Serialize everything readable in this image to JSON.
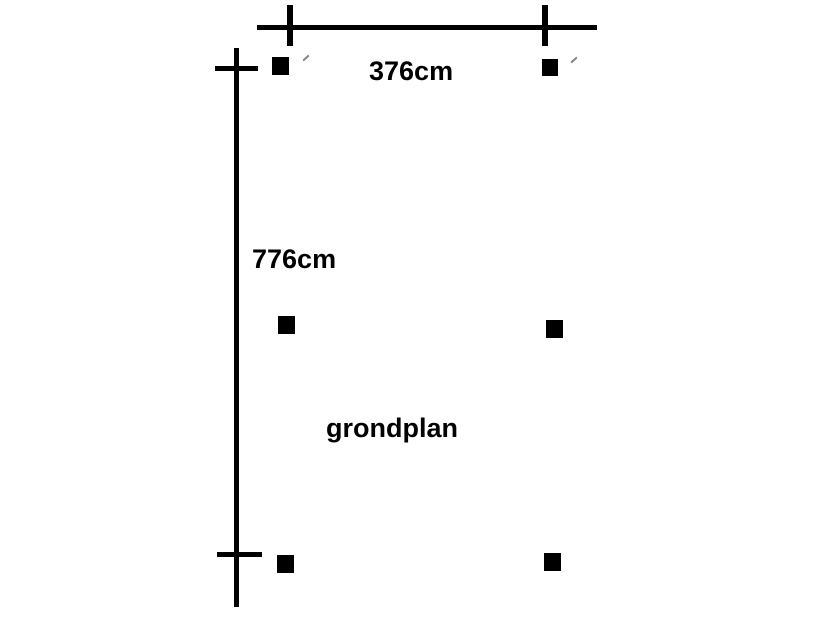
{
  "diagram": {
    "title": "grondplan",
    "dimensions": {
      "width_label": "376cm",
      "height_label": "776cm"
    },
    "markers": {
      "post_marker": "black-filled-square",
      "post_count": 6,
      "stray_mark": "small-gray-pen-tick",
      "stray_count": 2
    },
    "colors": {
      "ink": "#000000",
      "background": "#ffffff",
      "stray_mark": "#5a5a5a"
    }
  }
}
